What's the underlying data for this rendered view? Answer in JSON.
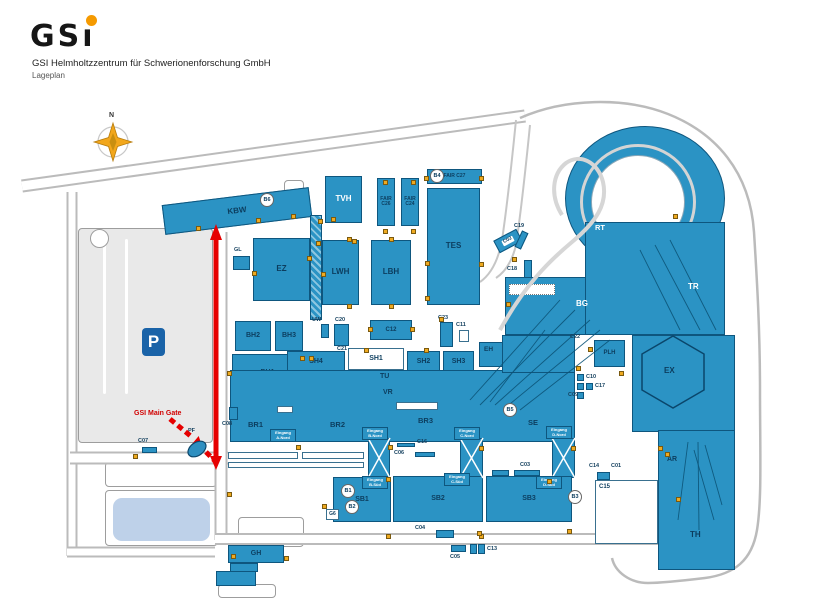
{
  "header": {
    "logo_gs": "GS",
    "logo_i": "ı",
    "org": "GSI Helmholtzzentrum für Schwerionenforschung GmbH",
    "subtitle": "Lageplan"
  },
  "compass": {
    "label": "N"
  },
  "parking": {
    "label": "P"
  },
  "route": {
    "gate_label": "GSI Main Gate"
  },
  "colors": {
    "building": "#2b93c4",
    "building_border": "#0e567e",
    "building_text": "#0c3d5e",
    "ground": "#e9e9e9",
    "road_border": "#bbbbbb",
    "water": "#bed1e9",
    "door_marker": "#efaa20",
    "route_red": "#e60000",
    "parking_blue": "#1a63a8",
    "logo_dot": "#f59a00"
  },
  "map": {
    "buildings": [
      {
        "id": "kbw",
        "label": "KBW",
        "x": 163,
        "y": 196,
        "w": 148,
        "h": 30,
        "rot": -7,
        "fs": 8
      },
      {
        "id": "tvh",
        "label": "TVH",
        "x": 325,
        "y": 176,
        "w": 37,
        "h": 47,
        "fs": 8,
        "lc": "#ffffff"
      },
      {
        "id": "fair-c26",
        "label": "FAIR\nC26",
        "x": 377,
        "y": 178,
        "w": 18,
        "h": 48,
        "fs": 5
      },
      {
        "id": "fair-c24",
        "label": "FAIR\nC24",
        "x": 401,
        "y": 178,
        "w": 18,
        "h": 48,
        "fs": 5
      },
      {
        "id": "fair-c27",
        "label": "FAIR C27",
        "x": 427,
        "y": 169,
        "w": 55,
        "h": 15,
        "fs": 5
      },
      {
        "id": "tes",
        "label": "TES",
        "x": 427,
        "y": 188,
        "w": 53,
        "h": 117,
        "fs": 8
      },
      {
        "id": "ez",
        "label": "EZ",
        "x": 253,
        "y": 238,
        "w": 57,
        "h": 63,
        "fs": 8
      },
      {
        "id": "gl-bldg",
        "label": "",
        "x": 233,
        "y": 256,
        "w": 17,
        "h": 14
      },
      {
        "id": "conveyor",
        "label": "",
        "x": 310,
        "y": 215,
        "w": 12,
        "h": 105,
        "cls": "hatchv"
      },
      {
        "id": "lwh",
        "label": "LWH",
        "x": 322,
        "y": 240,
        "w": 37,
        "h": 65,
        "fs": 8
      },
      {
        "id": "lbh",
        "label": "LBH",
        "x": 371,
        "y": 240,
        "w": 40,
        "h": 65,
        "fs": 8
      },
      {
        "id": "bh2",
        "label": "BH2",
        "x": 235,
        "y": 321,
        "w": 36,
        "h": 30,
        "fs": 7
      },
      {
        "id": "bh3",
        "label": "BH3",
        "x": 275,
        "y": 321,
        "w": 28,
        "h": 30,
        "fs": 7
      },
      {
        "id": "bh1",
        "label": "BH1",
        "x": 232,
        "y": 354,
        "w": 71,
        "h": 38,
        "fs": 7
      },
      {
        "id": "sh4",
        "label": "SH4",
        "x": 287,
        "y": 351,
        "w": 58,
        "h": 21,
        "fs": 7
      },
      {
        "id": "sh1",
        "label": "SH1",
        "x": 348,
        "y": 348,
        "w": 56,
        "h": 22,
        "fs": 7,
        "cls": "white"
      },
      {
        "id": "sh2",
        "label": "SH2",
        "x": 407,
        "y": 351,
        "w": 33,
        "h": 21,
        "fs": 7
      },
      {
        "id": "sh3",
        "label": "SH3",
        "x": 443,
        "y": 351,
        "w": 31,
        "h": 21,
        "fs": 7
      },
      {
        "id": "central-hall",
        "label": "",
        "x": 230,
        "y": 370,
        "w": 345,
        "h": 72
      },
      {
        "id": "c12",
        "label": "C12",
        "x": 370,
        "y": 320,
        "w": 42,
        "h": 20,
        "fs": 6
      },
      {
        "id": "c20-tower",
        "label": "",
        "x": 334,
        "y": 324,
        "w": 15,
        "h": 22
      },
      {
        "id": "uw-bldg",
        "label": "",
        "x": 321,
        "y": 324,
        "w": 8,
        "h": 14
      },
      {
        "id": "c23-tower",
        "label": "",
        "x": 440,
        "y": 322,
        "w": 13,
        "h": 25
      },
      {
        "id": "c11-bldg",
        "label": "",
        "x": 459,
        "y": 330,
        "w": 10,
        "h": 12,
        "cls": "white"
      },
      {
        "id": "eh-bldg",
        "label": "",
        "x": 479,
        "y": 342,
        "w": 24,
        "h": 25
      },
      {
        "id": "c02",
        "label": "C02",
        "x": 495,
        "y": 234,
        "w": 26,
        "h": 14,
        "rot": -28,
        "fs": 5,
        "cls": "wlabel"
      },
      {
        "id": "c19-bar",
        "label": "",
        "x": 518,
        "y": 231,
        "w": 7,
        "h": 18,
        "rot": 25
      },
      {
        "id": "c18-bar",
        "label": "",
        "x": 524,
        "y": 260,
        "w": 8,
        "h": 20
      },
      {
        "id": "bg-block",
        "label": "",
        "x": 505,
        "y": 277,
        "w": 95,
        "h": 58
      },
      {
        "id": "bg-hatch",
        "label": "",
        "x": 509,
        "y": 284,
        "w": 46,
        "h": 11,
        "cls": "dots"
      },
      {
        "id": "transfer-wedge",
        "label": "",
        "x": 502,
        "y": 335,
        "w": 73,
        "h": 38
      },
      {
        "id": "ring-blob",
        "label": "",
        "x": 565,
        "y": 126,
        "w": 160,
        "h": 145,
        "cls": "blob"
      },
      {
        "id": "ring-inner",
        "label": "",
        "x": 591,
        "y": 155,
        "w": 94,
        "h": 94,
        "cls": "whitec"
      },
      {
        "id": "ring-road",
        "label": "",
        "x": 580,
        "y": 144,
        "w": 116,
        "h": 116,
        "cls": "ringroad"
      },
      {
        "id": "rt-tr-block",
        "label": "",
        "x": 585,
        "y": 222,
        "w": 140,
        "h": 113
      },
      {
        "id": "ex-block",
        "label": "",
        "x": 632,
        "y": 335,
        "w": 103,
        "h": 97
      },
      {
        "id": "plh",
        "label": "PLH",
        "x": 594,
        "y": 340,
        "w": 31,
        "h": 27,
        "fs": 6
      },
      {
        "id": "c10-sq",
        "label": "",
        "x": 577,
        "y": 374,
        "w": 7,
        "h": 7
      },
      {
        "id": "c17-sq1",
        "label": "",
        "x": 577,
        "y": 383,
        "w": 7,
        "h": 7
      },
      {
        "id": "c17-sq2",
        "label": "",
        "x": 586,
        "y": 383,
        "w": 7,
        "h": 7
      },
      {
        "id": "c09-sq",
        "label": "",
        "x": 577,
        "y": 392,
        "w": 7,
        "h": 7
      },
      {
        "id": "c08-bar",
        "label": "",
        "x": 229,
        "y": 407,
        "w": 9,
        "h": 13
      },
      {
        "id": "c07-bar",
        "label": "",
        "x": 142,
        "y": 447,
        "w": 15,
        "h": 6
      },
      {
        "id": "xbrace-b",
        "label": "",
        "x": 368,
        "y": 438,
        "w": 22,
        "h": 40
      },
      {
        "id": "xbrace-c",
        "label": "",
        "x": 460,
        "y": 438,
        "w": 23,
        "h": 40
      },
      {
        "id": "xbrace-d",
        "label": "",
        "x": 552,
        "y": 438,
        "w": 23,
        "h": 40
      },
      {
        "id": "walkway1",
        "label": "",
        "x": 228,
        "y": 452,
        "w": 70,
        "h": 7,
        "cls": "white"
      },
      {
        "id": "walkway2",
        "label": "",
        "x": 302,
        "y": 452,
        "w": 62,
        "h": 7,
        "cls": "white"
      },
      {
        "id": "walkway3",
        "label": "",
        "x": 228,
        "y": 462,
        "w": 136,
        "h": 6,
        "cls": "white"
      },
      {
        "id": "vent1",
        "label": "",
        "x": 277,
        "y": 406,
        "w": 16,
        "h": 7,
        "cls": "white"
      },
      {
        "id": "vent2",
        "label": "",
        "x": 396,
        "y": 402,
        "w": 42,
        "h": 8,
        "cls": "white"
      },
      {
        "id": "sb1",
        "label": "SB1",
        "x": 333,
        "y": 477,
        "w": 58,
        "h": 45,
        "fs": 7
      },
      {
        "id": "sb2",
        "label": "SB2",
        "x": 393,
        "y": 476,
        "w": 90,
        "h": 46,
        "fs": 7
      },
      {
        "id": "sb3",
        "label": "SB3",
        "x": 486,
        "y": 476,
        "w": 86,
        "h": 46,
        "fs": 7
      },
      {
        "id": "g6-box",
        "label": "G6",
        "x": 326,
        "y": 509,
        "w": 13,
        "h": 11,
        "fs": 5,
        "cls": "white"
      },
      {
        "id": "c03-bar1",
        "label": "",
        "x": 492,
        "y": 470,
        "w": 17,
        "h": 6
      },
      {
        "id": "c03-bar2",
        "label": "",
        "x": 514,
        "y": 470,
        "w": 26,
        "h": 6
      },
      {
        "id": "c16-bar",
        "label": "",
        "x": 397,
        "y": 443,
        "w": 18,
        "h": 4
      },
      {
        "id": "c06-bar",
        "label": "",
        "x": 415,
        "y": 452,
        "w": 20,
        "h": 5
      },
      {
        "id": "c04-bldg",
        "label": "",
        "x": 436,
        "y": 530,
        "w": 18,
        "h": 8
      },
      {
        "id": "c05-bar",
        "label": "",
        "x": 451,
        "y": 545,
        "w": 15,
        "h": 7
      },
      {
        "id": "c13-sq1",
        "label": "",
        "x": 470,
        "y": 544,
        "w": 7,
        "h": 10
      },
      {
        "id": "c13-sq2",
        "label": "",
        "x": 478,
        "y": 544,
        "w": 7,
        "h": 10
      },
      {
        "id": "c14-sq",
        "label": "",
        "x": 597,
        "y": 472,
        "w": 13,
        "h": 8
      },
      {
        "id": "c15-bldg",
        "label": "C15",
        "x": 595,
        "y": 480,
        "w": 63,
        "h": 64,
        "fs": 6,
        "cls": "white tl"
      },
      {
        "id": "th",
        "label": "",
        "x": 658,
        "y": 430,
        "w": 77,
        "h": 140
      },
      {
        "id": "gh",
        "label": "GH",
        "x": 228,
        "y": 545,
        "w": 56,
        "h": 18,
        "fs": 7
      },
      {
        "id": "gh-ext1",
        "label": "",
        "x": 230,
        "y": 563,
        "w": 28,
        "h": 9
      },
      {
        "id": "gh-ext2",
        "label": "",
        "x": 216,
        "y": 571,
        "w": 40,
        "h": 15
      }
    ],
    "area_labels": [
      {
        "t": "TU",
        "x": 380,
        "y": 373,
        "fs": 7
      },
      {
        "t": "VR",
        "x": 383,
        "y": 389,
        "fs": 7
      },
      {
        "t": "BR1",
        "x": 248,
        "y": 420,
        "fs": 7.5
      },
      {
        "t": "BR2",
        "x": 330,
        "y": 420,
        "fs": 7.5
      },
      {
        "t": "BR3",
        "x": 418,
        "y": 416,
        "fs": 7.5
      },
      {
        "t": "SE",
        "x": 528,
        "y": 418,
        "fs": 7.5
      },
      {
        "t": "EH",
        "x": 484,
        "y": 346,
        "fs": 6.5
      },
      {
        "t": "BG",
        "x": 576,
        "y": 299,
        "fs": 8,
        "c": "#ffffff"
      },
      {
        "t": "RT",
        "x": 595,
        "y": 223,
        "fs": 7.5,
        "c": "#ffffff"
      },
      {
        "t": "TR",
        "x": 688,
        "y": 282,
        "fs": 8,
        "c": "#ffffff"
      },
      {
        "t": "EX",
        "x": 664,
        "y": 366,
        "fs": 8
      },
      {
        "t": "AR",
        "x": 667,
        "y": 456,
        "fs": 7
      },
      {
        "t": "TH",
        "x": 690,
        "y": 530,
        "fs": 8
      }
    ],
    "small_labels": [
      {
        "t": "GL",
        "x": 234,
        "y": 247
      },
      {
        "t": "UW",
        "x": 312,
        "y": 317
      },
      {
        "t": "C20",
        "x": 335,
        "y": 317
      },
      {
        "t": "C21",
        "x": 337,
        "y": 346
      },
      {
        "t": "C23",
        "x": 438,
        "y": 315
      },
      {
        "t": "C11",
        "x": 456,
        "y": 322
      },
      {
        "t": "C19",
        "x": 514,
        "y": 223
      },
      {
        "t": "C18",
        "x": 507,
        "y": 266
      },
      {
        "t": "C22",
        "x": 570,
        "y": 334
      },
      {
        "t": "C10",
        "x": 586,
        "y": 374
      },
      {
        "t": "C17",
        "x": 595,
        "y": 383
      },
      {
        "t": "C09",
        "x": 568,
        "y": 392
      },
      {
        "t": "C08",
        "x": 222,
        "y": 421
      },
      {
        "t": "PF",
        "x": 188,
        "y": 428
      },
      {
        "t": "C07",
        "x": 138,
        "y": 438
      },
      {
        "t": "C16",
        "x": 417,
        "y": 439
      },
      {
        "t": "C06",
        "x": 394,
        "y": 450
      },
      {
        "t": "C03",
        "x": 520,
        "y": 462
      },
      {
        "t": "C04",
        "x": 415,
        "y": 525
      },
      {
        "t": "C05",
        "x": 450,
        "y": 554
      },
      {
        "t": "C13",
        "x": 487,
        "y": 546
      },
      {
        "t": "C14",
        "x": 589,
        "y": 463
      },
      {
        "t": "C01",
        "x": 611,
        "y": 463
      }
    ],
    "circles": [
      {
        "t": "B6",
        "x": 267,
        "y": 200
      },
      {
        "t": "B4",
        "x": 437,
        "y": 176
      },
      {
        "t": "B5",
        "x": 510,
        "y": 410
      },
      {
        "t": "B1",
        "x": 348,
        "y": 491
      },
      {
        "t": "B2",
        "x": 352,
        "y": 507
      },
      {
        "t": "B3",
        "x": 575,
        "y": 497
      }
    ],
    "entrances": [
      {
        "x": 270,
        "y": 429,
        "lines": [
          "Eingang",
          "A-Nord"
        ]
      },
      {
        "x": 362,
        "y": 427,
        "lines": [
          "Eingang",
          "B-Nord"
        ]
      },
      {
        "x": 454,
        "y": 427,
        "lines": [
          "Eingang",
          "C-Nord"
        ]
      },
      {
        "x": 546,
        "y": 426,
        "lines": [
          "Eingang",
          "D-Nord"
        ]
      },
      {
        "x": 362,
        "y": 476,
        "lines": [
          "Eingang",
          "B-Süd"
        ]
      },
      {
        "x": 444,
        "y": 473,
        "lines": [
          "Eingang",
          "C-Süd"
        ]
      },
      {
        "x": 536,
        "y": 476,
        "lines": [
          "Eingang",
          "D-Süd"
        ]
      }
    ],
    "markers": [
      [
        196,
        226
      ],
      [
        256,
        218
      ],
      [
        291,
        214
      ],
      [
        318,
        219
      ],
      [
        331,
        217
      ],
      [
        352,
        239
      ],
      [
        383,
        180
      ],
      [
        411,
        180
      ],
      [
        383,
        229
      ],
      [
        411,
        229
      ],
      [
        424,
        176
      ],
      [
        479,
        176
      ],
      [
        425,
        261
      ],
      [
        425,
        296
      ],
      [
        479,
        262
      ],
      [
        307,
        256
      ],
      [
        252,
        271
      ],
      [
        321,
        272
      ],
      [
        347,
        304
      ],
      [
        347,
        237
      ],
      [
        389,
        304
      ],
      [
        389,
        237
      ],
      [
        368,
        327
      ],
      [
        410,
        327
      ],
      [
        364,
        348
      ],
      [
        424,
        348
      ],
      [
        300,
        356
      ],
      [
        309,
        356
      ],
      [
        439,
        317
      ],
      [
        227,
        371
      ],
      [
        316,
        241
      ],
      [
        512,
        257
      ],
      [
        506,
        302
      ],
      [
        576,
        366
      ],
      [
        619,
        371
      ],
      [
        588,
        347
      ],
      [
        133,
        454
      ],
      [
        296,
        445
      ],
      [
        388,
        445
      ],
      [
        479,
        446
      ],
      [
        571,
        446
      ],
      [
        322,
        504
      ],
      [
        386,
        477
      ],
      [
        386,
        534
      ],
      [
        479,
        534
      ],
      [
        547,
        479
      ],
      [
        567,
        529
      ],
      [
        231,
        554
      ],
      [
        284,
        556
      ],
      [
        477,
        531
      ],
      [
        658,
        446
      ],
      [
        665,
        452
      ],
      [
        676,
        497
      ],
      [
        673,
        214
      ],
      [
        227,
        492
      ]
    ]
  }
}
